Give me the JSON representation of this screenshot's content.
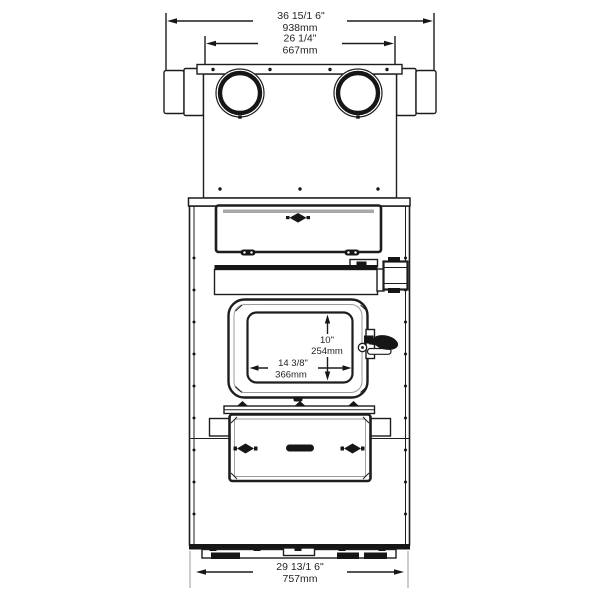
{
  "figure": {
    "title": "furnace-front-view-dimension-drawing",
    "background": "#ffffff",
    "line_color": "#1d1d1b",
    "text_color": "#231f20",
    "shading_gray": "#a8a8a8"
  },
  "dimensions": {
    "overall_width": {
      "inches": "36 15/1 6\"",
      "mm": "938mm"
    },
    "plenum_width": {
      "inches": "26 1/4\"",
      "mm": "667mm"
    },
    "door_opening_height": {
      "inches": "10\"",
      "mm": "254mm"
    },
    "door_opening_width": {
      "inches": "14 3/8\"",
      "mm": "366mm"
    },
    "base_width": {
      "inches": "29 13/1 6\"",
      "mm": "757mm"
    }
  }
}
